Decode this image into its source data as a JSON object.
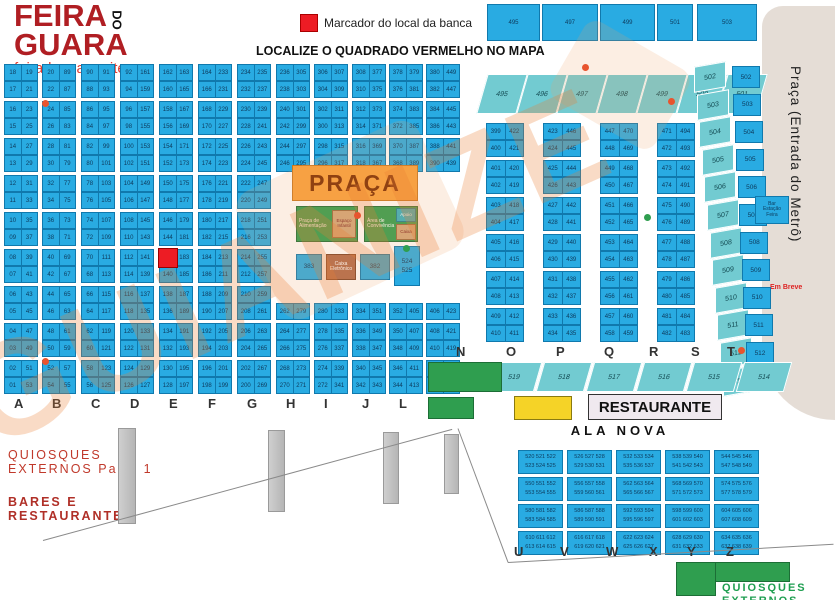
{
  "logo": {
    "line1": "FEIRA",
    "line2": "GUARA",
    "do": "DO",
    "site": "feiradoguara.site"
  },
  "legend": {
    "marker_label": "Marcador do local da banca",
    "headline": "LOCALIZE O QUADRADO VERMELHO NO MAPA"
  },
  "top_boxes": [
    "495",
    "497",
    "499",
    "501",
    "503"
  ],
  "watermark": "GUIANIZE",
  "grid": {
    "letters": [
      "A",
      "B",
      "C",
      "D",
      "E",
      "F",
      "G",
      "H",
      "I",
      "J",
      "L",
      "M"
    ],
    "columns": [
      {
        "letter": "A",
        "left": [
          "18",
          "17",
          "16",
          "15",
          "14",
          "13",
          "12",
          "11",
          "10",
          "09",
          "08",
          "07",
          "06",
          "05",
          "04",
          "03",
          "02",
          "01"
        ],
        "right": [
          "19",
          "21",
          "23",
          "25",
          "27",
          "29",
          "31",
          "33",
          "35",
          "37",
          "39",
          "41",
          "43",
          "45",
          "47",
          "49",
          "51",
          "53"
        ]
      },
      {
        "letter": "B",
        "left": [
          "20",
          "22",
          "24",
          "26",
          "28",
          "30",
          "32",
          "34",
          "36",
          "38",
          "40",
          "42",
          "44",
          "46",
          "48",
          "50",
          "52",
          "54"
        ],
        "right": [
          "89",
          "87",
          "85",
          "83",
          "81",
          "79",
          "77",
          "75",
          "73",
          "71",
          "69",
          "67",
          "65",
          "63",
          "61",
          "59",
          "57",
          "55"
        ]
      },
      {
        "letter": "C",
        "left": [
          "90",
          "88",
          "86",
          "84",
          "82",
          "80",
          "78",
          "76",
          "74",
          "72",
          "70",
          "68",
          "66",
          "64",
          "62",
          "60",
          "58",
          "56"
        ],
        "right": [
          "91",
          "93",
          "95",
          "97",
          "99",
          "101",
          "103",
          "105",
          "107",
          "109",
          "111",
          "113",
          "115",
          "117",
          "119",
          "121",
          "123",
          "125"
        ]
      },
      {
        "letter": "D",
        "left": [
          "92",
          "94",
          "96",
          "98",
          "100",
          "102",
          "104",
          "106",
          "108",
          "110",
          "112",
          "114",
          "116",
          "118",
          "120",
          "122",
          "124",
          "126"
        ],
        "right": [
          "161",
          "159",
          "157",
          "155",
          "153",
          "151",
          "149",
          "147",
          "145",
          "143",
          "141",
          "139",
          "137",
          "135",
          "133",
          "131",
          "129",
          "127"
        ]
      },
      {
        "letter": "E",
        "left": [
          "162",
          "160",
          "158",
          "156",
          "154",
          "152",
          "150",
          "148",
          "146",
          "144",
          null,
          "140",
          "138",
          "136",
          "134",
          "132",
          "130",
          "128"
        ],
        "right": [
          "163",
          "165",
          "167",
          "169",
          "171",
          "173",
          "175",
          "177",
          "179",
          "181",
          "183",
          "185",
          "187",
          "189",
          "191",
          "193",
          "195",
          "197"
        ]
      },
      {
        "letter": "F",
        "left": [
          "164",
          "166",
          "168",
          "170",
          "172",
          "174",
          "176",
          "178",
          "180",
          "182",
          "184",
          "186",
          "188",
          "190",
          "192",
          "194",
          "196",
          "198"
        ],
        "right": [
          "233",
          "231",
          "229",
          "227",
          "225",
          "223",
          "221",
          "219",
          "217",
          "215",
          "213",
          "211",
          "209",
          "207",
          "205",
          "203",
          "201",
          "199"
        ]
      },
      {
        "letter": "G",
        "left": [
          "234",
          "232",
          "230",
          "228",
          "226",
          "224",
          "222",
          "220",
          "218",
          "216",
          "214",
          "212",
          "210",
          "208",
          "206",
          "204",
          "202",
          "200"
        ],
        "right": [
          "235",
          "237",
          "239",
          "241",
          "243",
          "245",
          "247",
          "249",
          "251",
          "253",
          "255",
          "257",
          "259",
          "261",
          "263",
          "265",
          "267",
          "269"
        ]
      },
      {
        "letter": "H",
        "left": [
          "236",
          "238",
          "240",
          "242",
          "244",
          "246",
          null,
          null,
          null,
          null,
          null,
          null,
          null,
          "262",
          "264",
          "266",
          "268",
          "270"
        ],
        "right": [
          "305",
          "303",
          "301",
          "299",
          "297",
          "295",
          null,
          null,
          null,
          null,
          null,
          null,
          null,
          "279",
          "277",
          "275",
          "273",
          "271"
        ]
      },
      {
        "letter": "I",
        "left": [
          "306",
          "304",
          "302",
          "300",
          "298",
          "296",
          null,
          null,
          null,
          null,
          null,
          null,
          null,
          "280",
          "278",
          "276",
          "274",
          "272"
        ],
        "right": [
          "307",
          "309",
          "311",
          "313",
          "315",
          "317",
          null,
          null,
          null,
          null,
          null,
          null,
          null,
          "333",
          "335",
          "337",
          "339",
          "341"
        ]
      },
      {
        "letter": "J",
        "left": [
          "308",
          "310",
          "312",
          "314",
          "316",
          "318",
          null,
          null,
          null,
          null,
          null,
          null,
          null,
          "334",
          "336",
          "338",
          "340",
          "342"
        ],
        "right": [
          "377",
          "375",
          "373",
          "371",
          "369",
          "367",
          null,
          null,
          null,
          null,
          null,
          null,
          null,
          "351",
          "349",
          "347",
          "345",
          "343"
        ]
      },
      {
        "letter": "L",
        "left": [
          "378",
          "376",
          "374",
          "372",
          "370",
          "368",
          null,
          null,
          null,
          null,
          null,
          null,
          null,
          "352",
          "350",
          "348",
          "346",
          "344"
        ],
        "right": [
          "379",
          "381",
          "383",
          "385",
          "387",
          "389",
          null,
          null,
          null,
          null,
          null,
          null,
          null,
          "405",
          "407",
          "409",
          "411",
          "413"
        ]
      },
      {
        "letter": "M",
        "left": [
          "380",
          "382",
          "384",
          "386",
          "388",
          "390",
          null,
          null,
          null,
          null,
          null,
          null,
          null,
          "406",
          "408",
          "410",
          "412",
          "414"
        ],
        "right": [
          "449",
          "447",
          "445",
          "443",
          "441",
          "439",
          null,
          null,
          null,
          null,
          null,
          null,
          null,
          "423",
          "421",
          "419",
          "417",
          "415"
        ]
      }
    ]
  },
  "central_grid": {
    "columns": [
      {
        "left": [
          "399",
          "400",
          "401",
          "402",
          "403",
          "404",
          "405",
          "406",
          "407",
          "408",
          "409",
          "410"
        ],
        "right": [
          "422",
          "421",
          "420",
          "419",
          "418",
          "417",
          "416",
          "415",
          "414",
          "413",
          "412",
          "411"
        ]
      },
      {
        "left": [
          "423",
          "424",
          "425",
          "426",
          "427",
          "428",
          "429",
          "430",
          "431",
          "432",
          "433",
          "434"
        ],
        "right": [
          "446",
          "445",
          "444",
          "443",
          "442",
          "441",
          "440",
          "439",
          "438",
          "437",
          "436",
          "435"
        ]
      },
      {
        "left": [
          "447",
          "448",
          "449",
          "450",
          "451",
          "452",
          "453",
          "454",
          "455",
          "456",
          "457",
          "458"
        ],
        "right": [
          "470",
          "469",
          "468",
          "467",
          "466",
          "465",
          "464",
          "463",
          "462",
          "461",
          "460",
          "459"
        ]
      },
      {
        "left": [
          "471",
          "472",
          "473",
          "474",
          "475",
          "476",
          "477",
          "478",
          "479",
          "480",
          "481",
          "482"
        ],
        "right": [
          "494",
          "493",
          "492",
          "491",
          "490",
          "489",
          "488",
          "487",
          "486",
          "485",
          "484",
          "483"
        ]
      }
    ]
  },
  "strip_495": [
    "495",
    "496",
    "497",
    "498",
    "499",
    "500",
    "501"
  ],
  "right_section": {
    "vagas": [
      "502",
      "503",
      "504",
      "505",
      "506",
      "507",
      "508",
      "509",
      "510",
      "511",
      "512",
      "513"
    ],
    "lojas": [
      "502",
      "503",
      "504",
      "505",
      "506",
      "507",
      "508",
      "509",
      "510",
      "511",
      "512",
      "513"
    ],
    "bar": "Bar\nEstação\nFeira"
  },
  "metro": {
    "label": "Praça (Entrada do Metrô)",
    "soon": "Em Breve"
  },
  "praca": {
    "title": "PRAÇA",
    "green_left": "Praça de\nAlimentação",
    "tan_left": "Espaço\nInfantil",
    "green_right": "Área de\nConvivência",
    "teal_right": "Apoio",
    "tan_right": "Caixa",
    "box1": "383",
    "brown": "Caixa\nEletrônico",
    "box2": "382",
    "tall": "524\n525"
  },
  "nt": {
    "letters": [
      "N",
      "O",
      "P",
      "Q",
      "R",
      "S",
      "T"
    ],
    "strip": [
      "519",
      "518",
      "517",
      "516",
      "515",
      "514"
    ]
  },
  "restaurante_label": "RESTAURANTE",
  "ala_nova_label": "ALA NOVA",
  "uz_letters": [
    "U",
    "V",
    "W",
    "X",
    "Y",
    "Z"
  ],
  "ala_blocks": [
    [
      "520 521 522",
      "523 524 525"
    ],
    [
      "526 527 528",
      "529 530 531"
    ],
    [
      "532 533 534",
      "535 536 537"
    ],
    [
      "538 539 540",
      "541 542 543"
    ],
    [
      "544 545 546",
      "547 548 549"
    ],
    [
      "550 551 552",
      "553 554 555"
    ],
    [
      "556 557 558",
      "559 560 561"
    ],
    [
      "562 563 564",
      "565 566 567"
    ],
    [
      "568 569 570",
      "571 572 573"
    ],
    [
      "574 575 576",
      "577 578 579"
    ],
    [
      "580 581 582",
      "583 584 585"
    ],
    [
      "586 587 588",
      "589 590 591"
    ],
    [
      "592 593 594",
      "595 596 597"
    ],
    [
      "598 599 600",
      "601 602 603"
    ],
    [
      "604 605 606",
      "607 608 609"
    ],
    [
      "610 611 612",
      "613 614 615"
    ],
    [
      "616 617 618",
      "619 620 621"
    ],
    [
      "622 623 624",
      "625 626 627"
    ],
    [
      "628 629 630",
      "631 632 633"
    ],
    [
      "634 635 636",
      "637 638 639"
    ]
  ],
  "labels": {
    "quiosques1": "QUIOSQUES\nEXTERNOS Parte 1",
    "bares": "BARES E\nRESTAURANTES",
    "quiosques2": "QUIOSQUES\nEXTERNOS Parte 2"
  }
}
